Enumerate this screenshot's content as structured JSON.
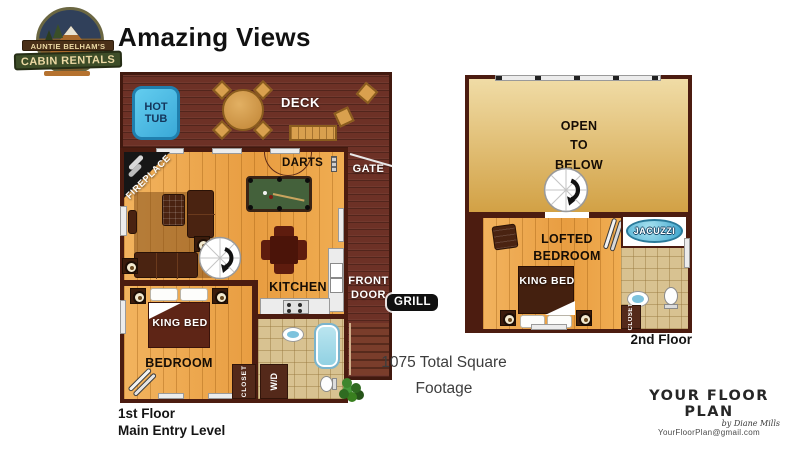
{
  "logo": {
    "line1": "AUNTIE BELHAM'S",
    "line2": "CABIN RENTALS"
  },
  "title": "Amazing Views",
  "floor1": {
    "hot_tub": "HOT TUB",
    "deck": "DECK",
    "darts": "DARTS",
    "gate": "GATE",
    "fireplace": "FIREPLACE",
    "front_door": "FRONT DOOR",
    "kitchen": "KITCHEN",
    "king_bed": "KING BED",
    "bedroom": "BEDROOM",
    "closet": "CLOSET",
    "washer_dryer": "W/D",
    "caption_line1": "1st Floor",
    "caption_line2": "Main Entry Level",
    "items": [
      "hot-tub",
      "round-table",
      "bench",
      "deck-chairs",
      "pool-table",
      "dartboard",
      "fireplace",
      "sofa",
      "armchair",
      "rug",
      "spiral-staircase",
      "dining-table",
      "kitchen-counters",
      "sink",
      "stove",
      "bathtub",
      "toilet",
      "king-bed",
      "nightstands",
      "skis",
      "plant"
    ]
  },
  "grill": "GRILL",
  "footage": "1075 Total Square Footage",
  "floor2": {
    "open_to_below": "OPEN TO BELOW",
    "lofted_bedroom": "LOFTED BEDROOM",
    "king_bed": "KING BED",
    "jacuzzi": "JACUZZI",
    "closet": "CLOSET",
    "caption": "2nd Floor",
    "items": [
      "spiral-staircase",
      "armchair",
      "skis",
      "king-bed",
      "nightstands",
      "jacuzzi",
      "bathroom-sink",
      "toilet"
    ]
  },
  "watermark": {
    "title": "YOUR FLOOR PLAN",
    "byline": "by Diane Mills",
    "email": "YourFloorPlan@gmail.com"
  },
  "colors": {
    "deck_brown": "#6d3126",
    "wall_maroon": "#4c1c10",
    "wood_floor": "#eda84f",
    "open_to_below_tan": "#d8ab52",
    "hot_tub_blue": "#4cc0e8",
    "pool_table_green": "#44613b",
    "bath_tile": "#d8c291",
    "tub_blue": "#a5dceb",
    "jacuzzi_blue": "#57b8d8",
    "grill_badge": "#111111",
    "plant_green": "#3e862d"
  }
}
